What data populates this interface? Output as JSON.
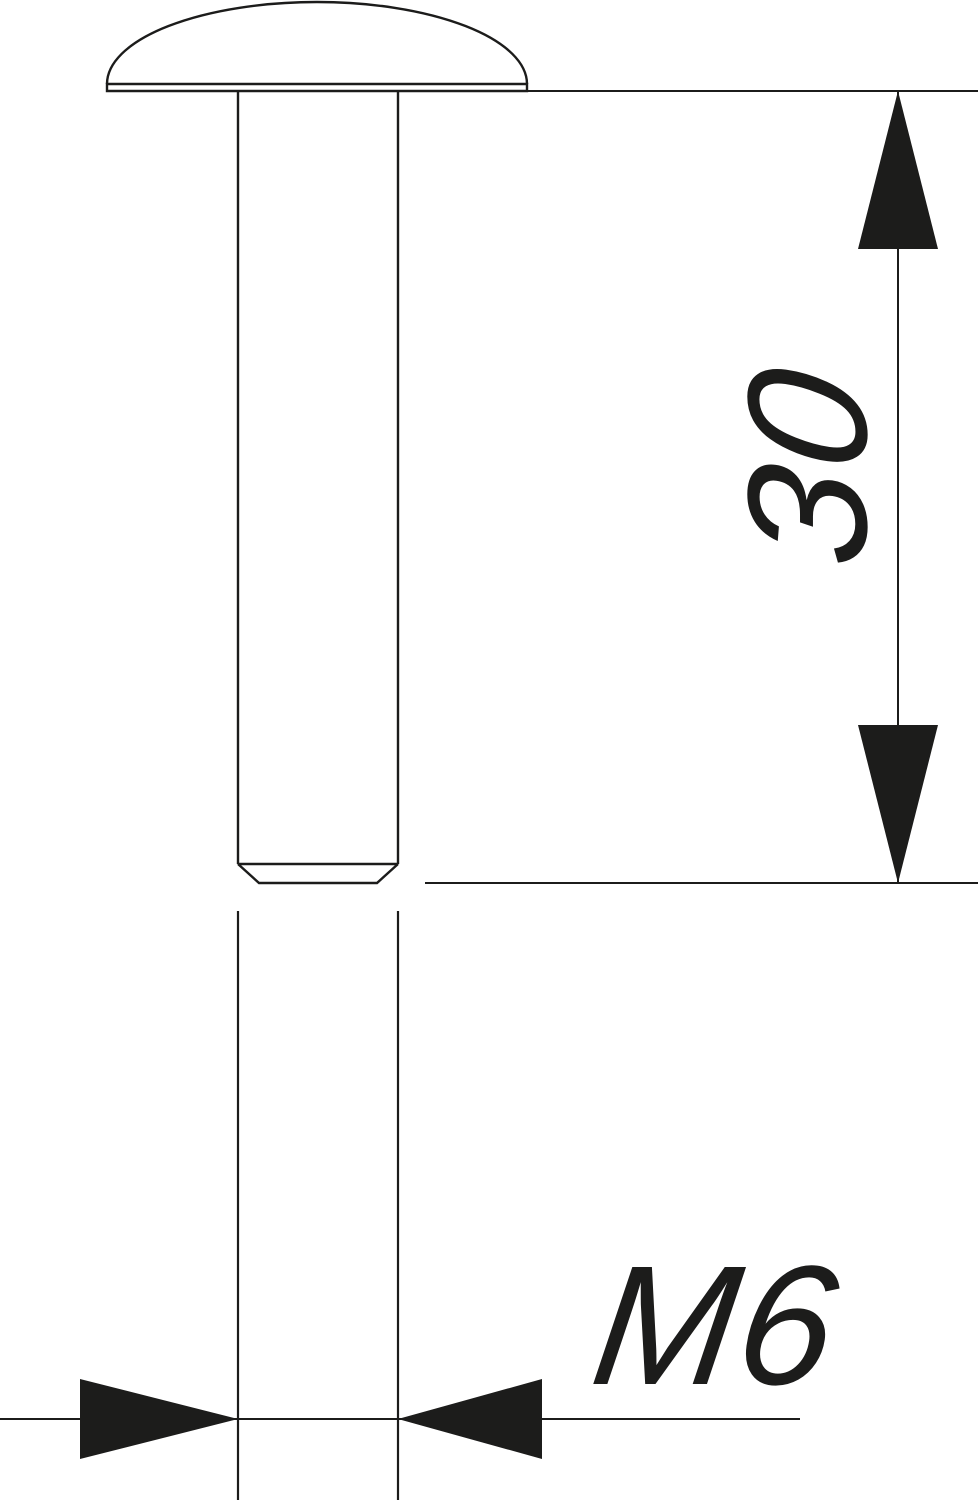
{
  "drawing": {
    "background": "#ffffff",
    "line_color": "#1c1c1b",
    "length_dimension": {
      "label": "30"
    },
    "thread_dimension": {
      "label": "M6"
    }
  }
}
